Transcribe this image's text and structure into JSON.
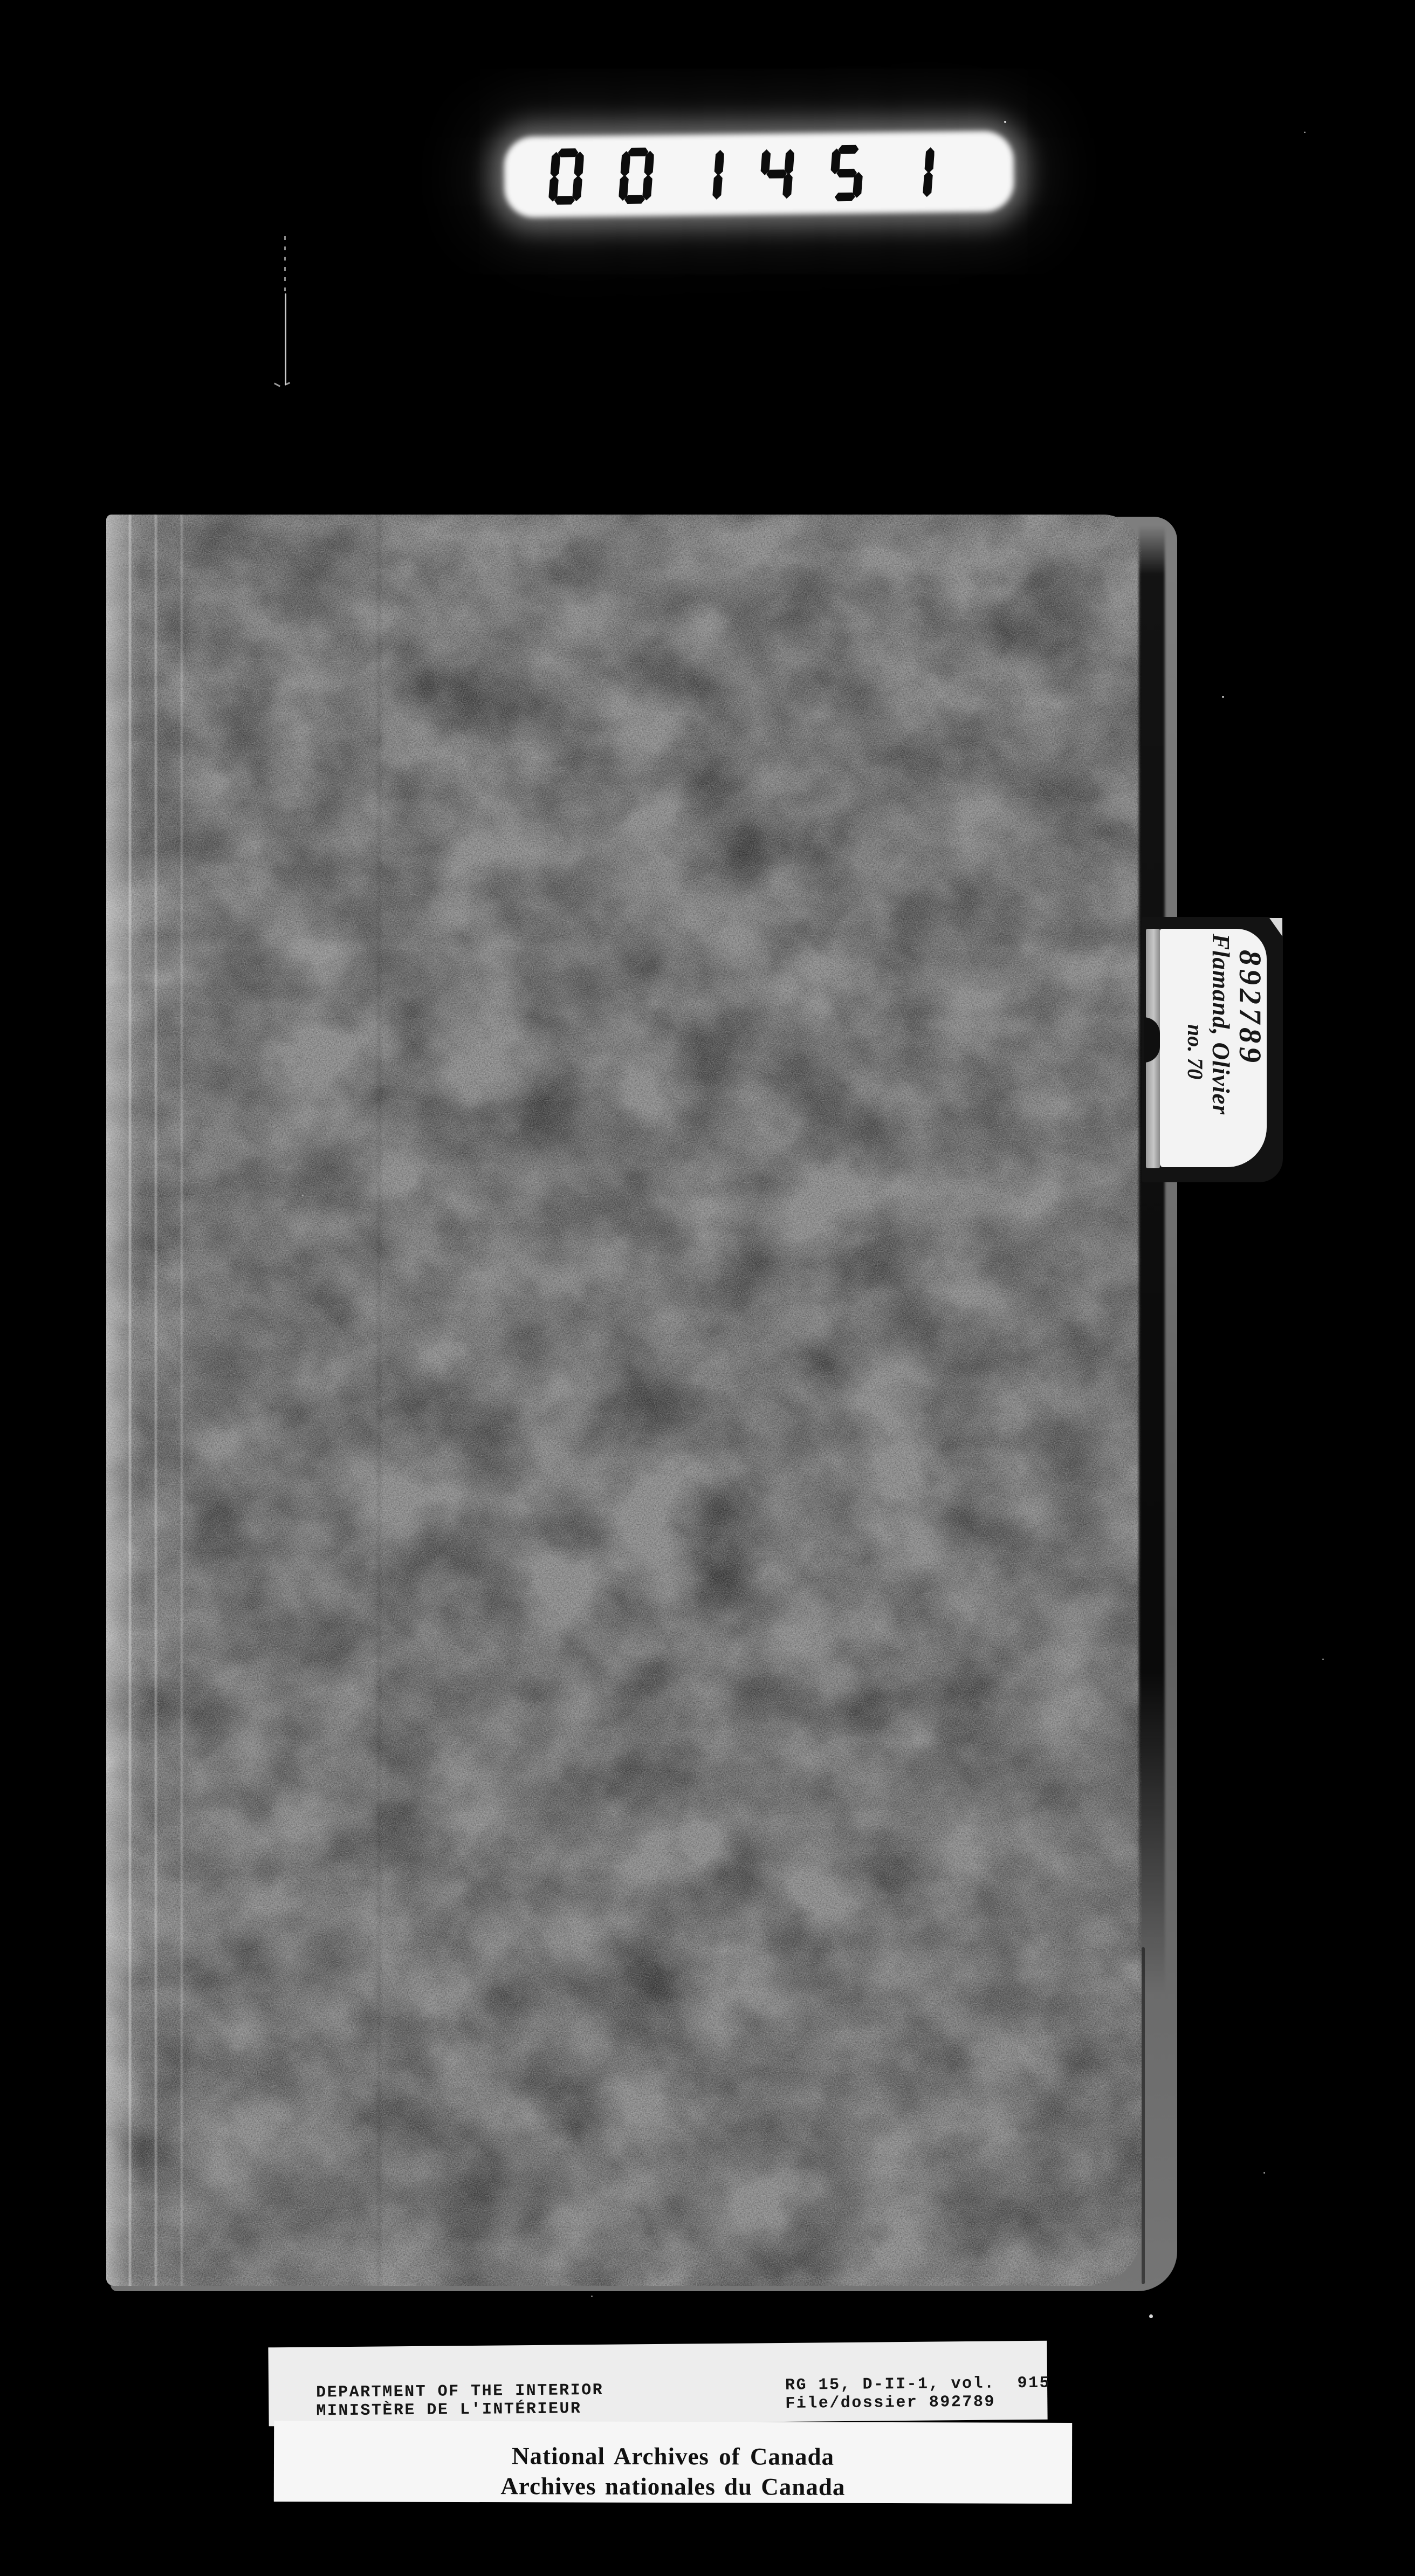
{
  "counter": {
    "value": "001451"
  },
  "tab": {
    "file_number": "892789",
    "name": "Flamand, Olivier",
    "note": "no. 70"
  },
  "reference_label": {
    "dept_en": "DEPARTMENT OF THE INTERIOR",
    "dept_fr": "MINISTÈRE DE L'INTÉRIEUR",
    "rg_line": "RG 15, D-II-1, vol.  915",
    "file_line": "File/dossier 892789"
  },
  "archives_label": {
    "en": "National Archives of Canada",
    "fr": "Archives nationales du Canada"
  },
  "colors": {
    "background": "#000000",
    "folder_gray": "#8a8a8a",
    "label_white": "#f3f3f3",
    "counter_digit": "#0c0c0c"
  }
}
